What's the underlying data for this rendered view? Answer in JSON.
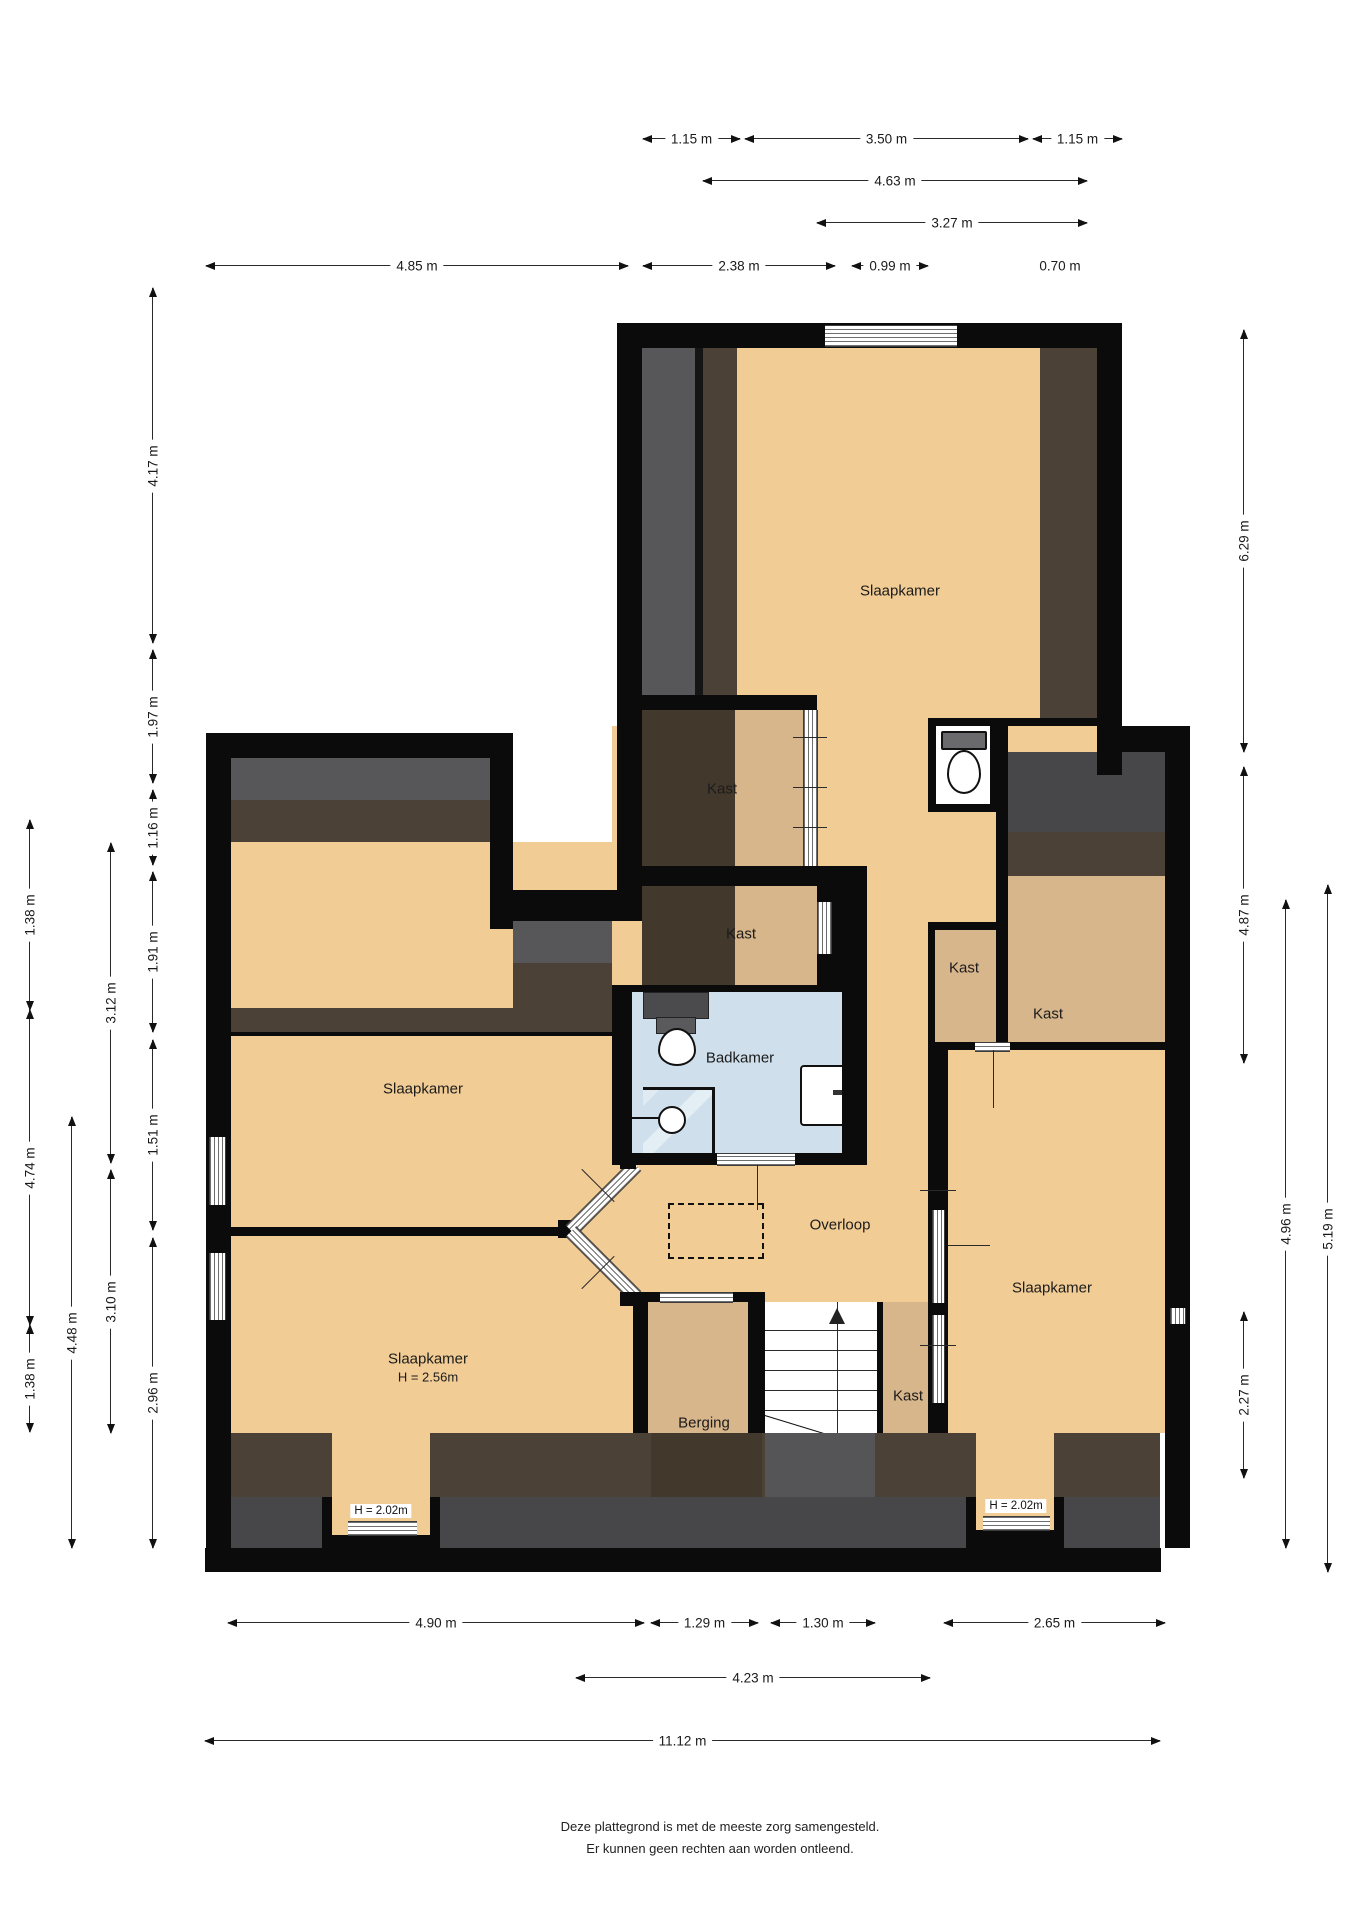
{
  "document_type": "floor-plan",
  "footer": {
    "line1": "Deze plattegrond is met de meeste zorg samengesteld.",
    "line2": "Er kunnen geen rechten aan worden ontleend."
  },
  "colors": {
    "wall": "#0b0b0b",
    "room_orange": "#f1cc95",
    "closet_tan": "#d8b68b",
    "bathroom_blue": "#cfe0ec",
    "slope_gray": "#57575a",
    "slope_gray_dark": "#47474a",
    "slope_brown": "#4c4136",
    "slope_brown_dark": "#43382c"
  },
  "plan": {
    "rooms": [
      {
        "label": "Slaapkamer",
        "x": 900,
        "y": 592
      },
      {
        "label": "Kast",
        "x": 722,
        "y": 790
      },
      {
        "label": "Kast",
        "x": 741,
        "y": 935
      },
      {
        "label": "Kast",
        "x": 964,
        "y": 969
      },
      {
        "label": "Kast",
        "x": 1048,
        "y": 1015
      },
      {
        "label": "Badkamer",
        "x": 740,
        "y": 1059
      },
      {
        "label": "Slaapkamer",
        "x": 423,
        "y": 1090
      },
      {
        "label": "Overloop",
        "x": 840,
        "y": 1226
      },
      {
        "label": "Slaapkamer",
        "x": 1052,
        "y": 1289
      },
      {
        "label": "Slaapkamer",
        "sub": "H = 2.56m",
        "x": 428,
        "y": 1368
      },
      {
        "label": "Kast",
        "x": 908,
        "y": 1397
      },
      {
        "label": "Berging",
        "x": 704,
        "y": 1424
      }
    ],
    "height_boxes": [
      {
        "text": "H = 2.02m",
        "x": 381,
        "y": 1511
      },
      {
        "text": "H = 2.02m",
        "x": 1016,
        "y": 1506
      }
    ],
    "dims_top": [
      {
        "label": "1.15 m",
        "x1": 643,
        "x2": 740,
        "y": 138
      },
      {
        "label": "3.50 m",
        "x1": 745,
        "x2": 1028,
        "y": 138
      },
      {
        "label": "1.15 m",
        "x1": 1033,
        "x2": 1122,
        "y": 138
      },
      {
        "label": "4.63 m",
        "x1": 703,
        "x2": 1087,
        "y": 180
      },
      {
        "label": "3.27 m",
        "x1": 817,
        "x2": 1087,
        "y": 222
      },
      {
        "label": "4.85 m",
        "x1": 206,
        "x2": 628,
        "y": 265
      },
      {
        "label": "2.38 m",
        "x1": 643,
        "x2": 835,
        "y": 265
      },
      {
        "label": "0.99 m",
        "x1": 852,
        "x2": 928,
        "y": 265
      }
    ],
    "dims_top_text_only": [
      {
        "label": "0.70 m",
        "x": 1060,
        "y": 266
      }
    ],
    "dims_bottom": [
      {
        "label": "4.90 m",
        "x1": 228,
        "x2": 644,
        "y": 1622
      },
      {
        "label": "1.29 m",
        "x1": 651,
        "x2": 758,
        "y": 1622
      },
      {
        "label": "1.30 m",
        "x1": 771,
        "x2": 875,
        "y": 1622
      },
      {
        "label": "2.65 m",
        "x1": 944,
        "x2": 1165,
        "y": 1622
      },
      {
        "label": "4.23 m",
        "x1": 576,
        "x2": 930,
        "y": 1677
      },
      {
        "label": "11.12 m",
        "x1": 205,
        "x2": 1160,
        "y": 1740
      }
    ],
    "dims_left": [
      {
        "label": "4.17 m",
        "y1": 288,
        "y2": 643,
        "x": 152
      },
      {
        "label": "1.97 m",
        "y1": 650,
        "y2": 783,
        "x": 152
      },
      {
        "label": "1.16 m",
        "y1": 790,
        "y2": 865,
        "x": 152
      },
      {
        "label": "1.91 m",
        "y1": 872,
        "y2": 1032,
        "x": 152
      },
      {
        "label": "1.51 m",
        "y1": 1040,
        "y2": 1230,
        "x": 152
      },
      {
        "label": "2.96 m",
        "y1": 1238,
        "y2": 1548,
        "x": 152
      },
      {
        "label": "3.12 m",
        "y1": 843,
        "y2": 1163,
        "x": 110
      },
      {
        "label": "3.10 m",
        "y1": 1170,
        "y2": 1433,
        "x": 110
      },
      {
        "label": "4.48 m",
        "y1": 1117,
        "y2": 1548,
        "x": 71
      },
      {
        "label": "1.38 m",
        "y1": 820,
        "y2": 1010,
        "x": 29
      },
      {
        "label": "4.74 m",
        "y1": 1010,
        "y2": 1325,
        "x": 29
      },
      {
        "label": "1.38 m",
        "y1": 1325,
        "y2": 1432,
        "x": 29
      }
    ],
    "dims_right": [
      {
        "label": "6.29 m",
        "y1": 330,
        "y2": 752,
        "x": 1243
      },
      {
        "label": "4.87 m",
        "y1": 767,
        "y2": 1063,
        "x": 1243
      },
      {
        "label": "2.27 m",
        "y1": 1312,
        "y2": 1478,
        "x": 1243
      },
      {
        "label": "4.96 m",
        "y1": 900,
        "y2": 1548,
        "x": 1285
      },
      {
        "label": "5.19 m",
        "y1": 885,
        "y2": 1572,
        "x": 1327
      }
    ]
  }
}
